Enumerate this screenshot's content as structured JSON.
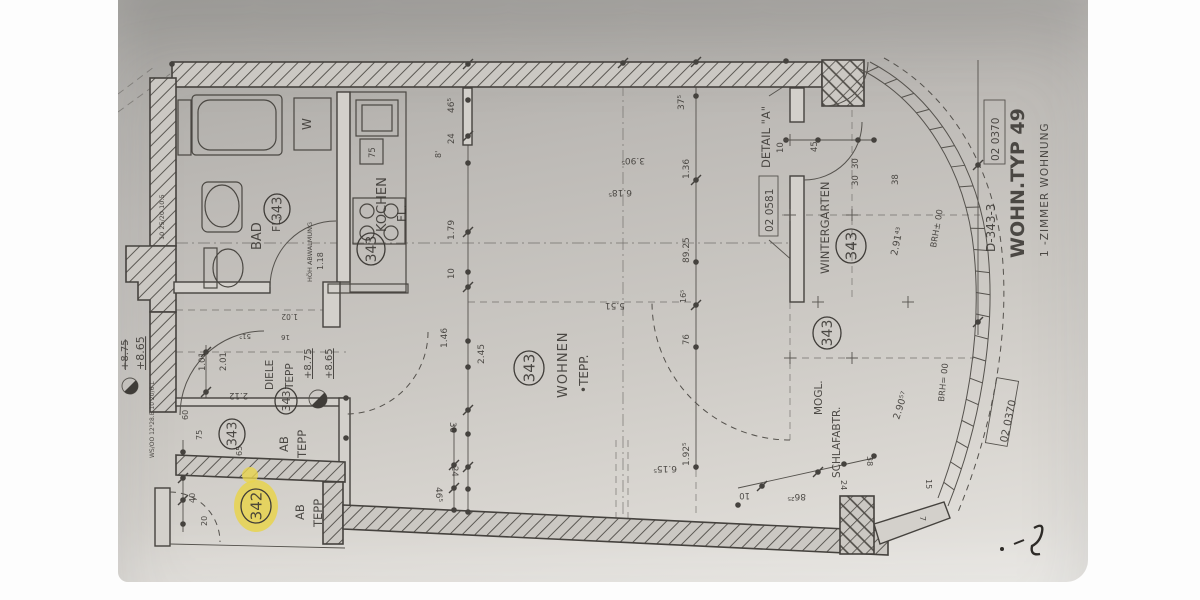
{
  "colors": {
    "paper_top": "#a8a6a2",
    "paper_bottom": "#e6e4e0",
    "ink": "#3a3733",
    "highlight": "#e8d44e",
    "margin": "#ffffff"
  },
  "labels": [
    {
      "name": "title-drawing-code",
      "t": "D-343-3",
      "x": 877,
      "y": 252,
      "rot": -90,
      "size": 12
    },
    {
      "name": "title-sheet-number",
      "t": "02 0370",
      "x": 881,
      "y": 161,
      "rot": -90,
      "size": 10.5
    },
    {
      "name": "title-wohn-typ",
      "t": "WOHN.TYP 49",
      "x": 906,
      "y": 258,
      "rot": -90,
      "size": 19,
      "w": 700
    },
    {
      "name": "title-subtitle",
      "t": "1 -ZIMMER WOHNUNG",
      "x": 930,
      "y": 257,
      "rot": -90,
      "size": 10.5,
      "ls": 1
    },
    {
      "name": "sheet-number-2",
      "t": "02 0370",
      "x": 889,
      "y": 443,
      "rot": -78,
      "size": 10.5
    },
    {
      "name": "detail-a-label",
      "t": "DETAIL \"A\"",
      "x": 652,
      "y": 168,
      "rot": -90,
      "size": 11.5
    },
    {
      "name": "detail-ref",
      "t": "02 0581",
      "x": 655,
      "y": 232,
      "rot": -90,
      "size": 10.5
    },
    {
      "name": "room-bad",
      "t": "BAD",
      "x": 143,
      "y": 250,
      "rot": -90,
      "size": 13
    },
    {
      "name": "room-bad-fl",
      "t": "FL.",
      "x": 162,
      "y": 232,
      "rot": -90,
      "size": 11
    },
    {
      "name": "note-abwalmung",
      "t": "HÖH ABWALMUNG",
      "x": 194,
      "y": 282,
      "rot": -90,
      "size": 6.5
    },
    {
      "name": "note-abwalmung-dim",
      "t": "1.18",
      "x": 205,
      "y": 270,
      "rot": -90,
      "size": 8
    },
    {
      "name": "washer-w",
      "t": "W",
      "x": 193,
      "y": 130,
      "rot": -90,
      "size": 12
    },
    {
      "name": "room-kochen",
      "t": "KOCHEN",
      "x": 268,
      "y": 232,
      "rot": -90,
      "size": 13
    },
    {
      "name": "room-kochen-fl",
      "t": "FL.",
      "x": 288,
      "y": 222,
      "rot": -90,
      "size": 12
    },
    {
      "name": "room-wohnen",
      "t": "WOHNEN",
      "x": 449,
      "y": 398,
      "rot": -90,
      "size": 13,
      "ls": 1
    },
    {
      "name": "room-wohnen-tepp",
      "t": "•TEPP.",
      "x": 470,
      "y": 393,
      "rot": -90,
      "size": 12
    },
    {
      "name": "room-diele",
      "t": "DIELE",
      "x": 155,
      "y": 390,
      "rot": -90,
      "size": 10.5
    },
    {
      "name": "room-diele-tepp",
      "t": "TEPP",
      "x": 175,
      "y": 389,
      "rot": -90,
      "size": 10.5
    },
    {
      "name": "level-875",
      "t": "+8.75",
      "x": 193,
      "y": 379,
      "rot": -90,
      "size": 10,
      "deco": "underline"
    },
    {
      "name": "level-865",
      "t": "+8.65",
      "x": 214,
      "y": 379,
      "rot": -90,
      "size": 10,
      "deco": "underline"
    },
    {
      "name": "room-ab1",
      "t": "AB",
      "x": 170,
      "y": 452,
      "rot": -90,
      "size": 11.5
    },
    {
      "name": "room-ab1-tepp",
      "t": "TEPP",
      "x": 188,
      "y": 458,
      "rot": -90,
      "size": 11.5
    },
    {
      "name": "room-ab2",
      "t": "AB",
      "x": 186,
      "y": 520,
      "rot": -90,
      "size": 11.5
    },
    {
      "name": "room-ab2-tepp",
      "t": "TEPP",
      "x": 204,
      "y": 527,
      "rot": -90,
      "size": 11.5
    },
    {
      "name": "room-wintergarten",
      "t": "WINTERGARTEN",
      "x": 711,
      "y": 274,
      "rot": -90,
      "size": 11.5
    },
    {
      "name": "room-moegl",
      "t": "MOGL.",
      "x": 704,
      "y": 415,
      "rot": -90,
      "size": 10.5
    },
    {
      "name": "room-schlafabtr",
      "t": "SCHLAFABTR.",
      "x": 722,
      "y": 478,
      "rot": -90,
      "size": 10.5
    },
    {
      "name": "brh-upper",
      "t": "BRH± 00",
      "x": 818,
      "y": 248,
      "rot": -80,
      "size": 8.5
    },
    {
      "name": "brh-lower",
      "t": "BRH= 00",
      "x": 826,
      "y": 402,
      "rot": -84,
      "size": 8.5
    },
    {
      "name": "dim-291",
      "t": "2.91⁴³",
      "x": 779,
      "y": 256,
      "rot": -78,
      "size": 9.5
    },
    {
      "name": "dim-290",
      "t": "2.90⁵⁷",
      "x": 781,
      "y": 420,
      "rot": -72,
      "size": 9.5
    },
    {
      "name": "level-875-edge",
      "t": "+8.75",
      "x": 10,
      "y": 370,
      "rot": -90,
      "size": 10,
      "deco": "line-through"
    },
    {
      "name": "level-865-edge",
      "t": "+8.65",
      "x": 26,
      "y": 370,
      "rot": -90,
      "size": 11,
      "deco": "underline"
    },
    {
      "name": "note-wall-spec",
      "t": "WS/OO 12⁵28.E 10 20/6 L",
      "x": 36,
      "y": 458,
      "rot": -90,
      "size": 6
    },
    {
      "name": "note-wall-spec-2",
      "t": "10 25/20 10.5",
      "x": 46,
      "y": 240,
      "rot": -90,
      "size": 6.5
    },
    {
      "name": "dim-465-top",
      "t": "46⁵",
      "x": 336,
      "y": 113,
      "rot": -90,
      "size": 9
    },
    {
      "name": "dim-24-top",
      "t": "24",
      "x": 336,
      "y": 144,
      "rot": -90,
      "size": 8.5
    },
    {
      "name": "dim-8",
      "t": "8'",
      "x": 323,
      "y": 158,
      "rot": -90,
      "size": 8
    },
    {
      "name": "dim-179",
      "t": "1.79",
      "x": 336,
      "y": 240,
      "rot": -90,
      "size": 9
    },
    {
      "name": "dim-10-k",
      "t": "10",
      "x": 336,
      "y": 279,
      "rot": -90,
      "size": 8.5
    },
    {
      "name": "dim-75",
      "t": "75",
      "x": 257,
      "y": 158,
      "rot": -90,
      "size": 8.5
    },
    {
      "name": "dim-375",
      "t": "37⁵",
      "x": 566,
      "y": 110,
      "rot": -90,
      "size": 9
    },
    {
      "name": "dim-136",
      "t": "1.36",
      "x": 571,
      "y": 179,
      "rot": -90,
      "size": 9
    },
    {
      "name": "dim-8925",
      "t": "89.25",
      "x": 571,
      "y": 263,
      "rot": -90,
      "size": 9
    },
    {
      "name": "dim-165",
      "t": "16⁵",
      "x": 568,
      "y": 303,
      "rot": -90,
      "size": 8
    },
    {
      "name": "dim-76",
      "t": "76",
      "x": 571,
      "y": 345,
      "rot": -90,
      "size": 8.5
    },
    {
      "name": "dim-1925",
      "t": "1.92⁵",
      "x": 571,
      "y": 466,
      "rot": -90,
      "size": 9
    },
    {
      "name": "dim-146",
      "t": "1.46",
      "x": 329,
      "y": 348,
      "rot": -90,
      "size": 9
    },
    {
      "name": "dim-245",
      "t": "2.45",
      "x": 366,
      "y": 364,
      "rot": -90,
      "size": 9
    },
    {
      "name": "dim-101",
      "t": "1.01",
      "x": 87,
      "y": 371,
      "rot": -90,
      "size": 8.5
    },
    {
      "name": "dim-201",
      "t": "2.01",
      "x": 108,
      "y": 371,
      "rot": -90,
      "size": 8.5
    },
    {
      "name": "dim-10-wg",
      "t": "10",
      "x": 665,
      "y": 153,
      "rot": -90,
      "size": 8.5
    },
    {
      "name": "dim-45-wg",
      "t": "45",
      "x": 699,
      "y": 152,
      "rot": -90,
      "size": 8.5
    },
    {
      "name": "dim-30-wg1",
      "t": "30",
      "x": 740,
      "y": 169,
      "rot": -90,
      "size": 8.5
    },
    {
      "name": "dim-30-wg2",
      "t": "30",
      "x": 740,
      "y": 186,
      "rot": -90,
      "size": 8.5
    },
    {
      "name": "dim-38-wg",
      "t": "38",
      "x": 780,
      "y": 185,
      "rot": -90,
      "size": 8.5
    },
    {
      "name": "dim-40",
      "t": "40",
      "x": 77,
      "y": 503,
      "rot": -90,
      "size": 8
    },
    {
      "name": "dim-20",
      "t": "20",
      "x": 89,
      "y": 526,
      "rot": -90,
      "size": 8
    },
    {
      "name": "dim-75b",
      "t": "75",
      "x": 84,
      "y": 440,
      "rot": -90,
      "size": 8
    },
    {
      "name": "dim-65",
      "t": "65",
      "x": 124,
      "y": 456,
      "rot": -90,
      "size": 8
    },
    {
      "name": "dim-60",
      "t": "60",
      "x": 70,
      "y": 420,
      "rot": -90,
      "size": 8
    },
    {
      "name": "dim-390",
      "t": "3.90⁵",
      "x": 527,
      "y": 158,
      "rot": 180,
      "size": 9
    },
    {
      "name": "dim-618",
      "t": "6.18⁵",
      "x": 514,
      "y": 190,
      "rot": 180,
      "size": 9
    },
    {
      "name": "dim-551",
      "t": "5.51",
      "x": 507,
      "y": 303,
      "rot": 180,
      "size": 9
    },
    {
      "name": "dim-615",
      "t": "6.15⁵",
      "x": 559,
      "y": 466,
      "rot": 180,
      "size": 9
    },
    {
      "name": "dim-8625",
      "t": "86²⁵",
      "x": 688,
      "y": 494,
      "rot": 180,
      "size": 9
    },
    {
      "name": "dim-10-b",
      "t": "10",
      "x": 632,
      "y": 493,
      "rot": 180,
      "size": 8.5
    },
    {
      "name": "dim-212",
      "t": "2.12",
      "x": 130,
      "y": 393,
      "rot": 180,
      "size": 8.5
    },
    {
      "name": "dim-102",
      "t": "1.02",
      "x": 180,
      "y": 314,
      "rot": 180,
      "size": 7.5
    },
    {
      "name": "dim-16",
      "t": "16",
      "x": 172,
      "y": 335,
      "rot": 180,
      "size": 7
    },
    {
      "name": "dim-515",
      "t": "51⁵",
      "x": 133,
      "y": 334,
      "rot": 180,
      "size": 7
    },
    {
      "name": "dim-24-br",
      "t": "24",
      "x": 723,
      "y": 480,
      "rot": 90,
      "size": 8
    },
    {
      "name": "dim-38-br",
      "t": "38",
      "x": 749,
      "y": 456,
      "rot": 90,
      "size": 8
    },
    {
      "name": "dim-15-br",
      "t": "15",
      "x": 808,
      "y": 479,
      "rot": 90,
      "size": 8
    },
    {
      "name": "dim-7-br",
      "t": "7",
      "x": 802,
      "y": 516,
      "rot": 90,
      "size": 8
    },
    {
      "name": "dim-465-bot",
      "t": "46⁵",
      "x": 318,
      "y": 487,
      "rot": 90,
      "size": 9
    },
    {
      "name": "dim-24-bot",
      "t": "24",
      "x": 334,
      "y": 466,
      "rot": 90,
      "size": 8.5
    },
    {
      "name": "dim-36-bot",
      "t": "36",
      "x": 332,
      "y": 422,
      "rot": 90,
      "size": 8.5
    }
  ],
  "circled": [
    {
      "v": "343",
      "x": 159,
      "y": 209,
      "r": 13
    },
    {
      "v": "343",
      "x": 253,
      "y": 249,
      "r": 14
    },
    {
      "v": "343",
      "x": 411,
      "y": 368,
      "r": 15
    },
    {
      "v": "343",
      "x": 168,
      "y": 401,
      "r": 11
    },
    {
      "v": "343",
      "x": 114,
      "y": 434,
      "r": 13
    },
    {
      "v": "342",
      "x": 138,
      "y": 506,
      "r": 15,
      "hl": true
    },
    {
      "v": "343",
      "x": 733,
      "y": 246,
      "r": 15
    },
    {
      "v": "343",
      "x": 709,
      "y": 333,
      "r": 14
    }
  ]
}
